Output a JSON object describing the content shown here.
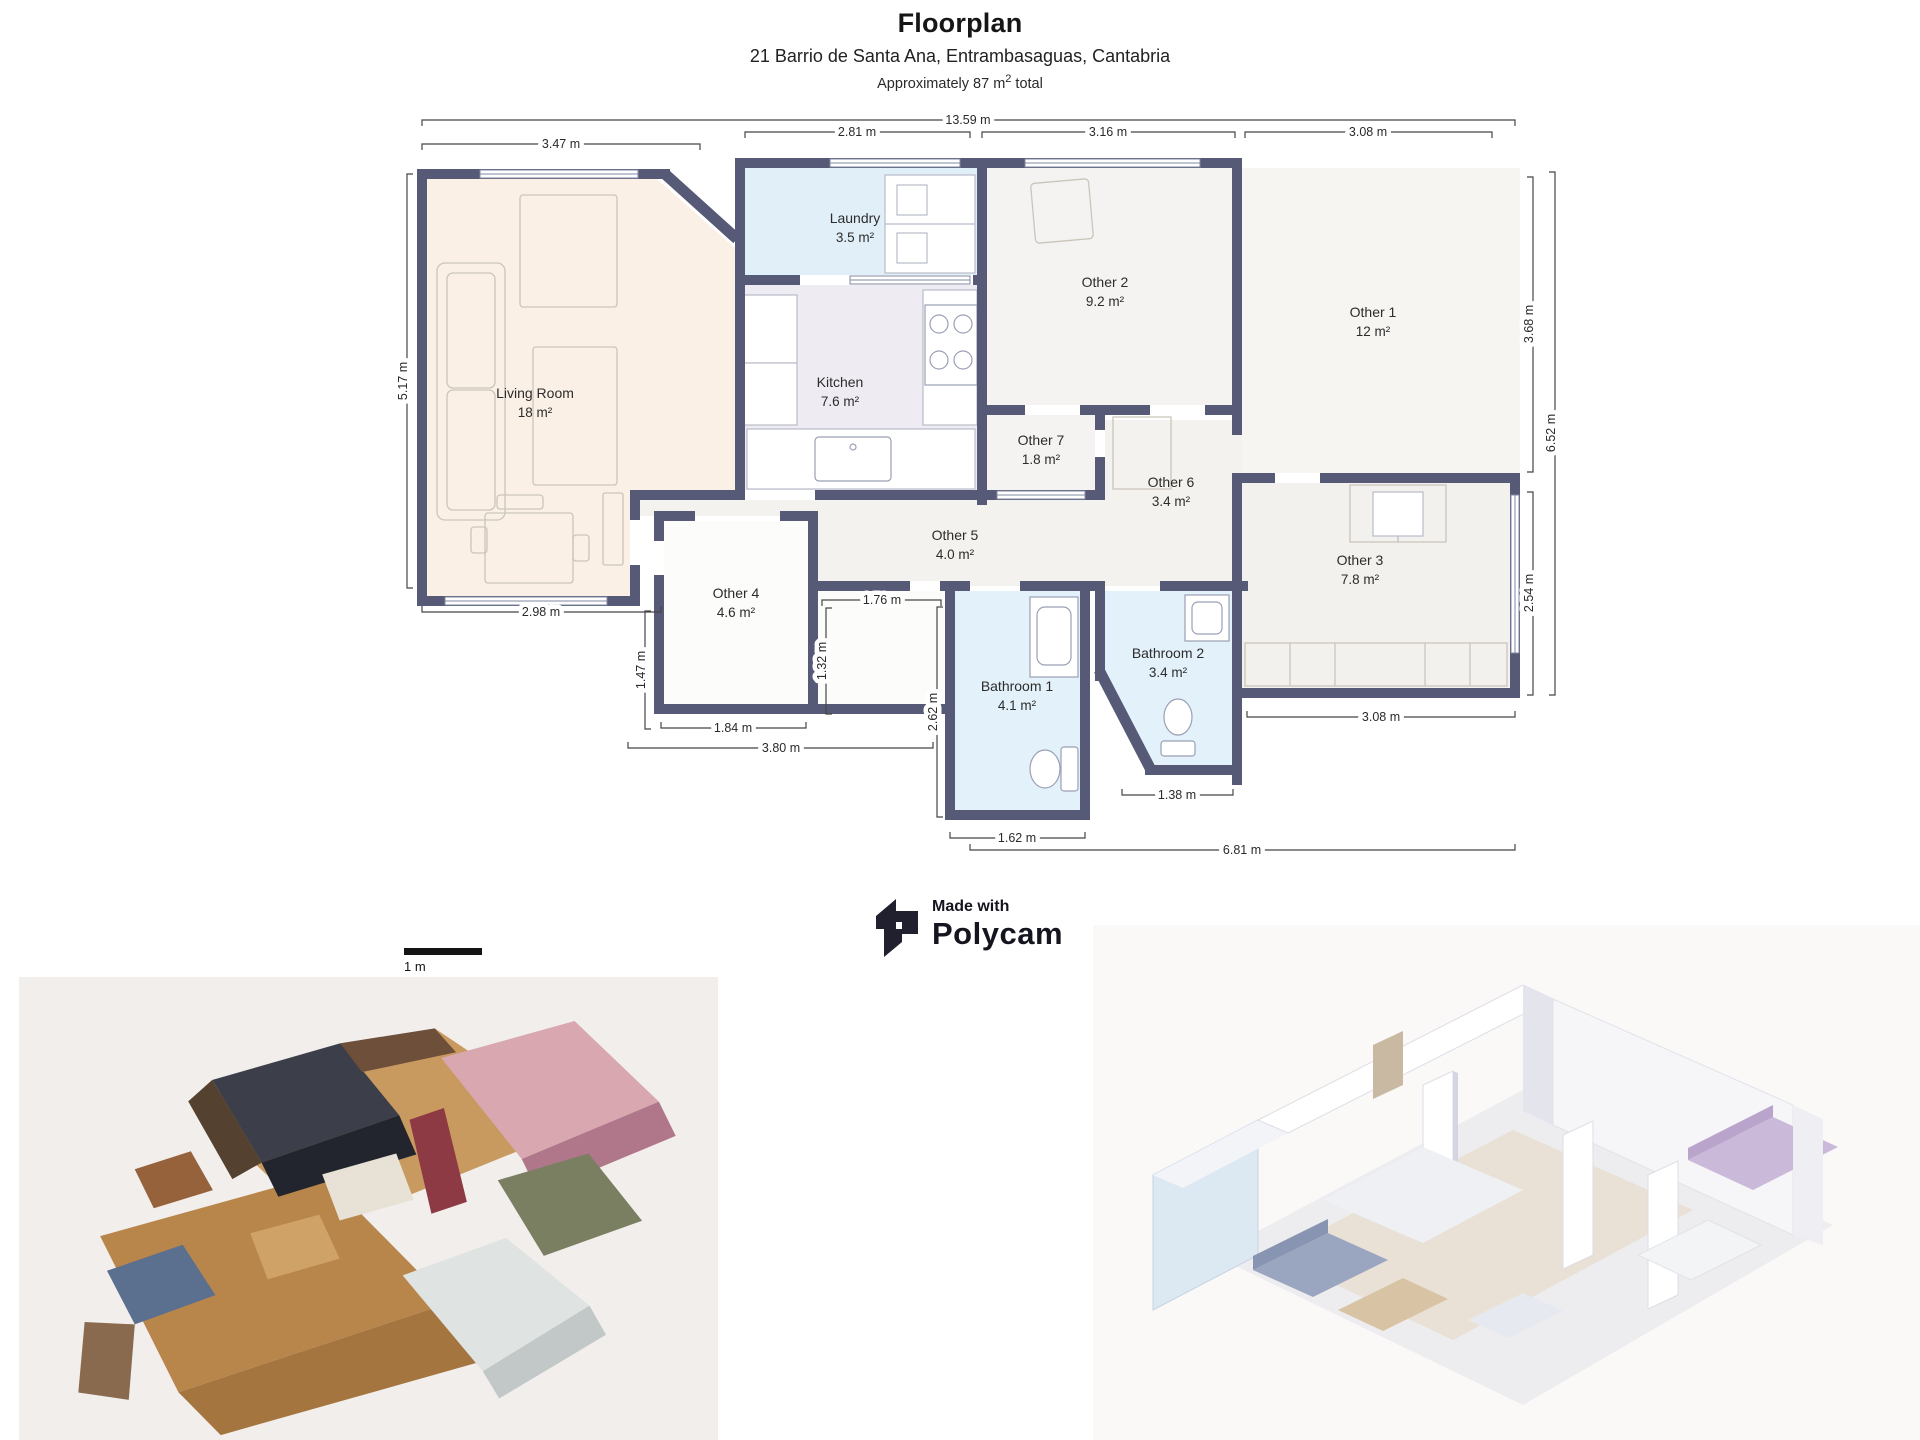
{
  "header": {
    "title": "Floorplan",
    "address": "21 Barrio de Santa Ana, Entrambasaguas, Cantabria",
    "area_prefix": "Approximately 87 m",
    "area_sup": "2",
    "area_suffix": " total"
  },
  "branding": {
    "made_with": "Made with",
    "brand": "Polycam"
  },
  "scale_bar": {
    "label": "1 m"
  },
  "floorplan": {
    "rooms": [
      {
        "name": "Living Room",
        "area": "18 m²"
      },
      {
        "name": "Laundry",
        "area": "3.5 m²"
      },
      {
        "name": "Kitchen",
        "area": "7.6 m²"
      },
      {
        "name": "Other 2",
        "area": "9.2 m²"
      },
      {
        "name": "Other 1",
        "area": "12 m²"
      },
      {
        "name": "Other 7",
        "area": "1.8 m²"
      },
      {
        "name": "Other 6",
        "area": "3.4 m²"
      },
      {
        "name": "Other 5",
        "area": "4.0 m²"
      },
      {
        "name": "Other 4",
        "area": "4.6 m²"
      },
      {
        "name": "Other 3",
        "area": "7.8 m²"
      },
      {
        "name": "Bathroom 1",
        "area": "4.1 m²"
      },
      {
        "name": "Bathroom 2",
        "area": "3.4 m²"
      }
    ],
    "dimensions": {
      "top_total": "13.59 m",
      "top_living": "3.47 m",
      "top_laundry": "2.81 m",
      "top_other2": "3.16 m",
      "top_other1": "3.08 m",
      "left_living": "5.17 m",
      "bottom_living": "2.98 m",
      "left_other4": "1.47 m",
      "bottom_other4": "1.84 m",
      "bottom_hall": "3.80 m",
      "inner_width": "1.76 m",
      "inner_height": "1.32 m",
      "left_bath1": "2.62 m",
      "bottom_bath1": "1.62 m",
      "bottom_bath2": "1.38 m",
      "bottom_other3": "3.08 m",
      "bottom_total": "6.81 m",
      "right_other1": "3.68 m",
      "right_other3": "2.54 m",
      "right_total": "6.52 m"
    }
  }
}
